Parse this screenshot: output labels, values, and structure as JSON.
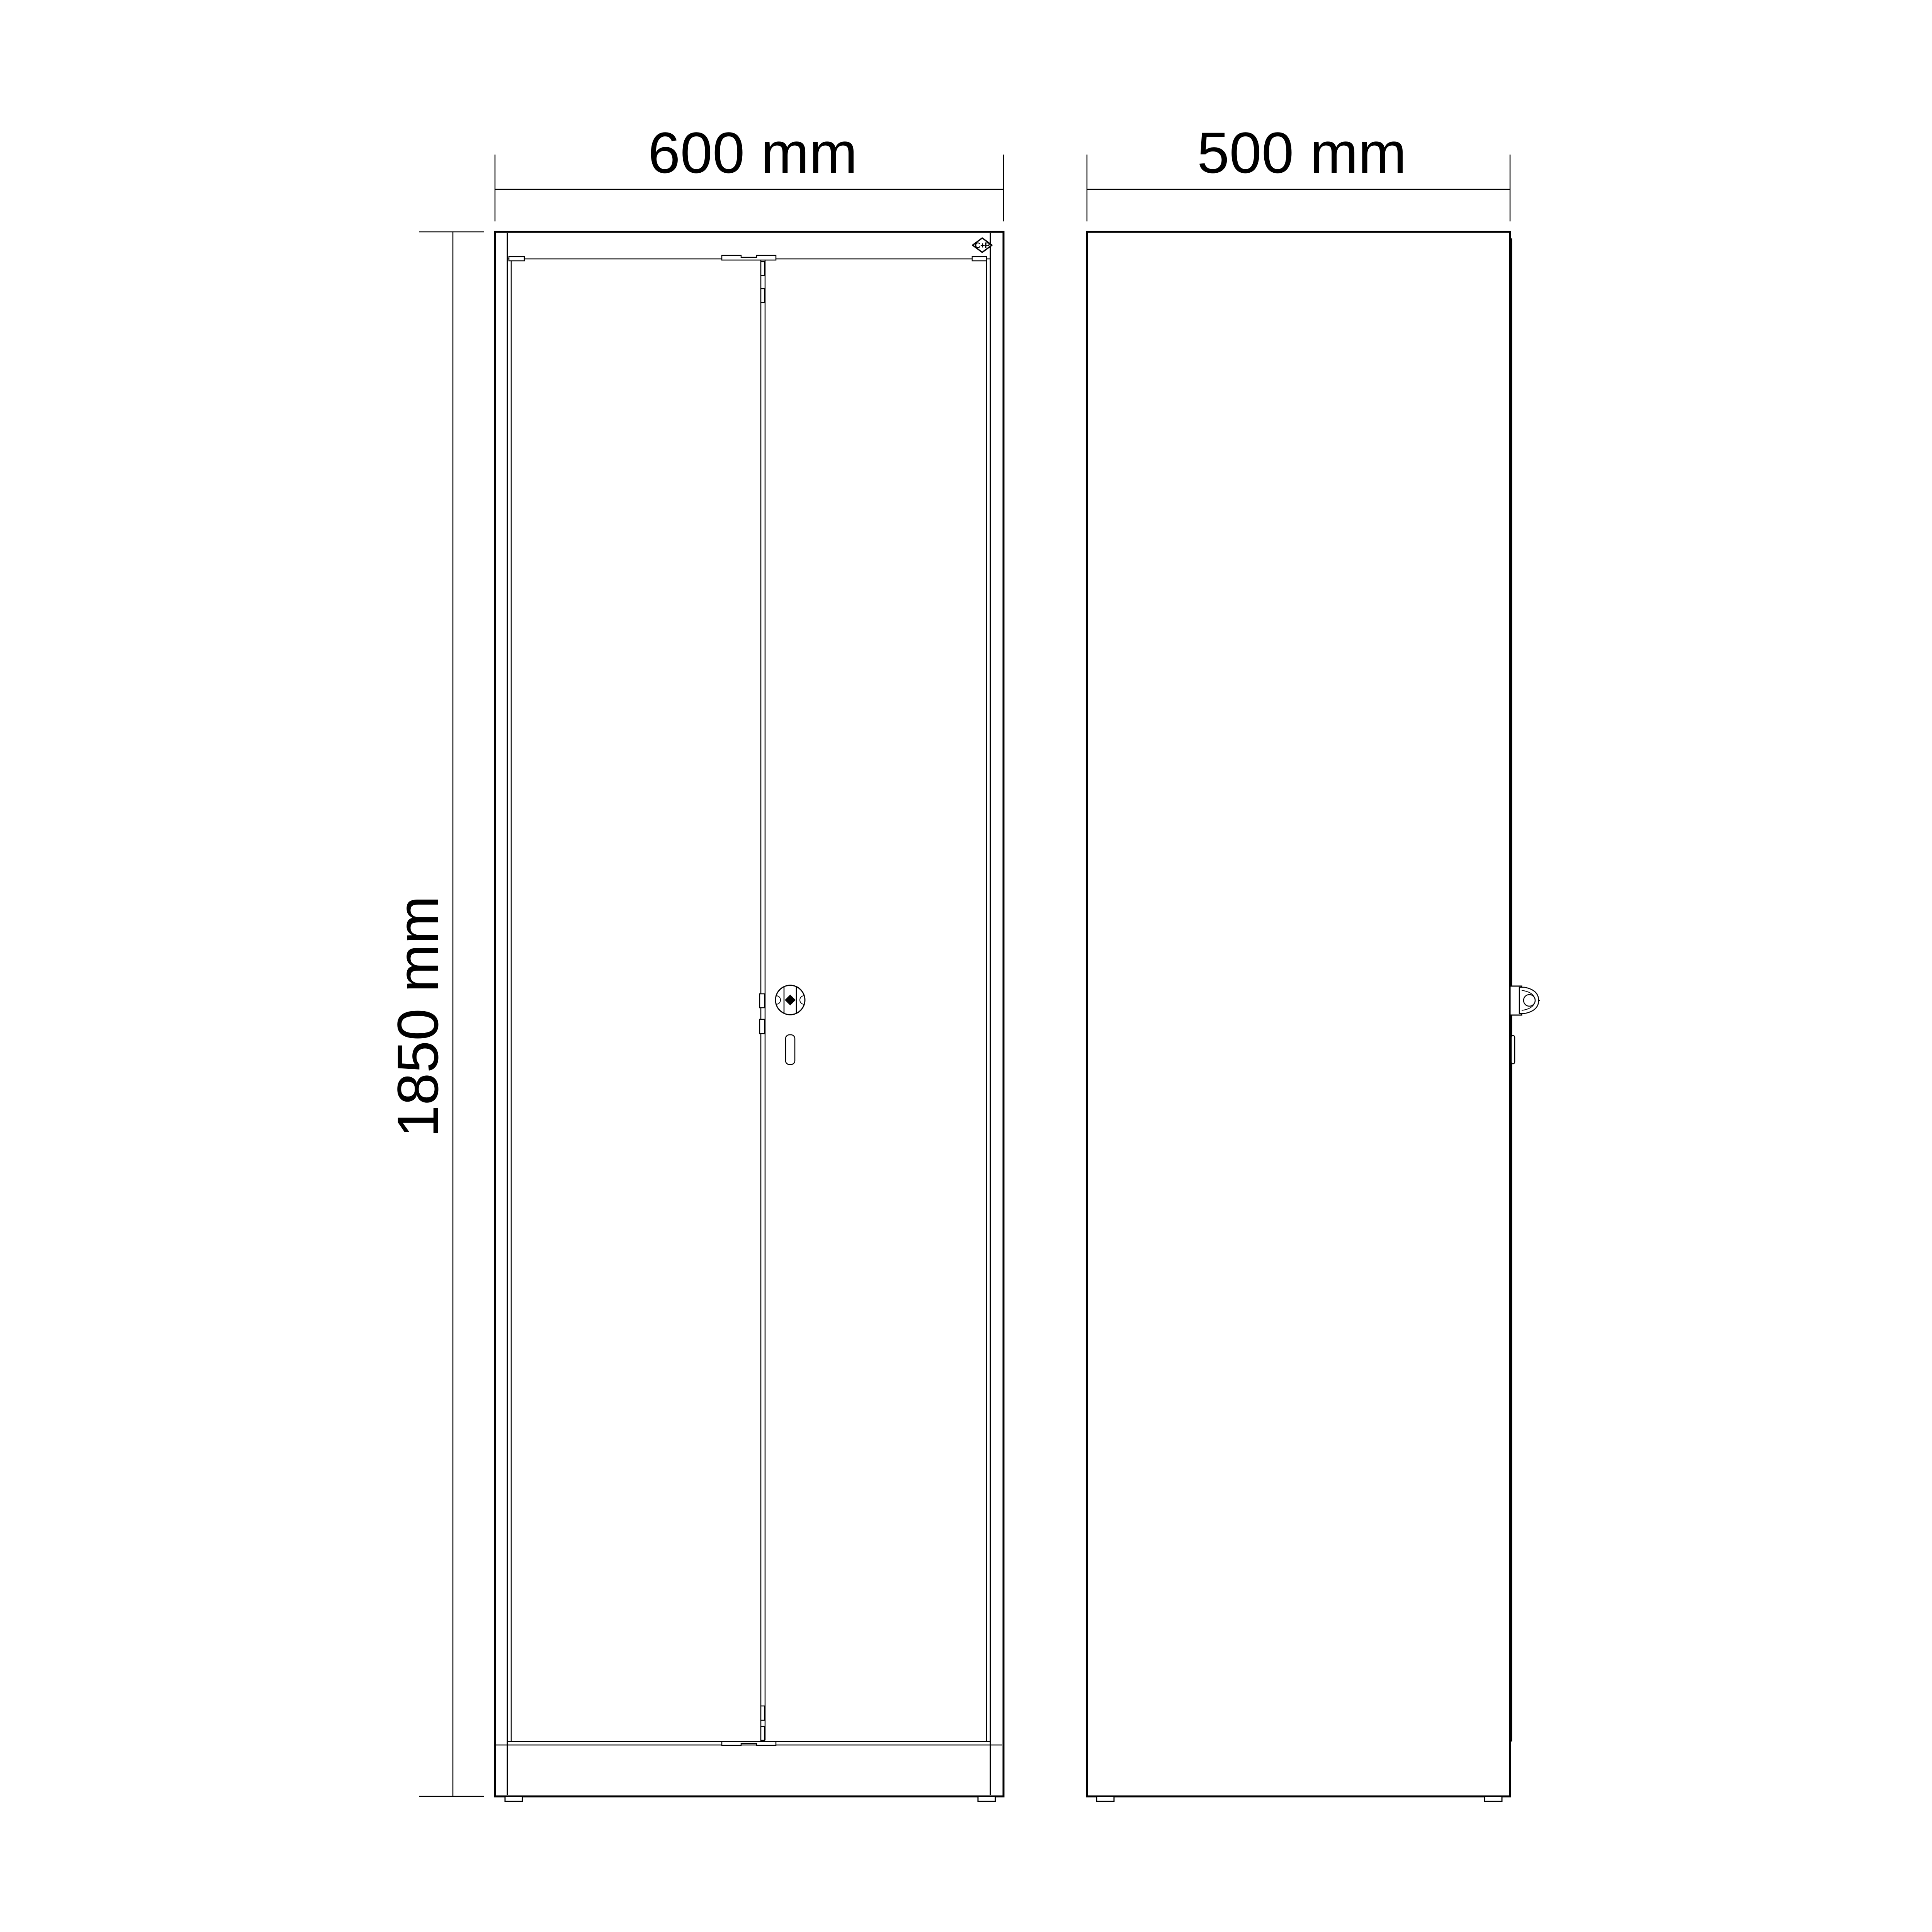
{
  "page": {
    "background": "#ffffff"
  },
  "colors": {
    "line": "#000000",
    "text": "#000000",
    "fill": "#ffffff"
  },
  "views": {
    "front": {
      "width_label": "600 mm",
      "height_label": "1850 mm"
    },
    "side": {
      "depth_label": "500 mm"
    }
  },
  "logo": {
    "text": "C+P"
  }
}
